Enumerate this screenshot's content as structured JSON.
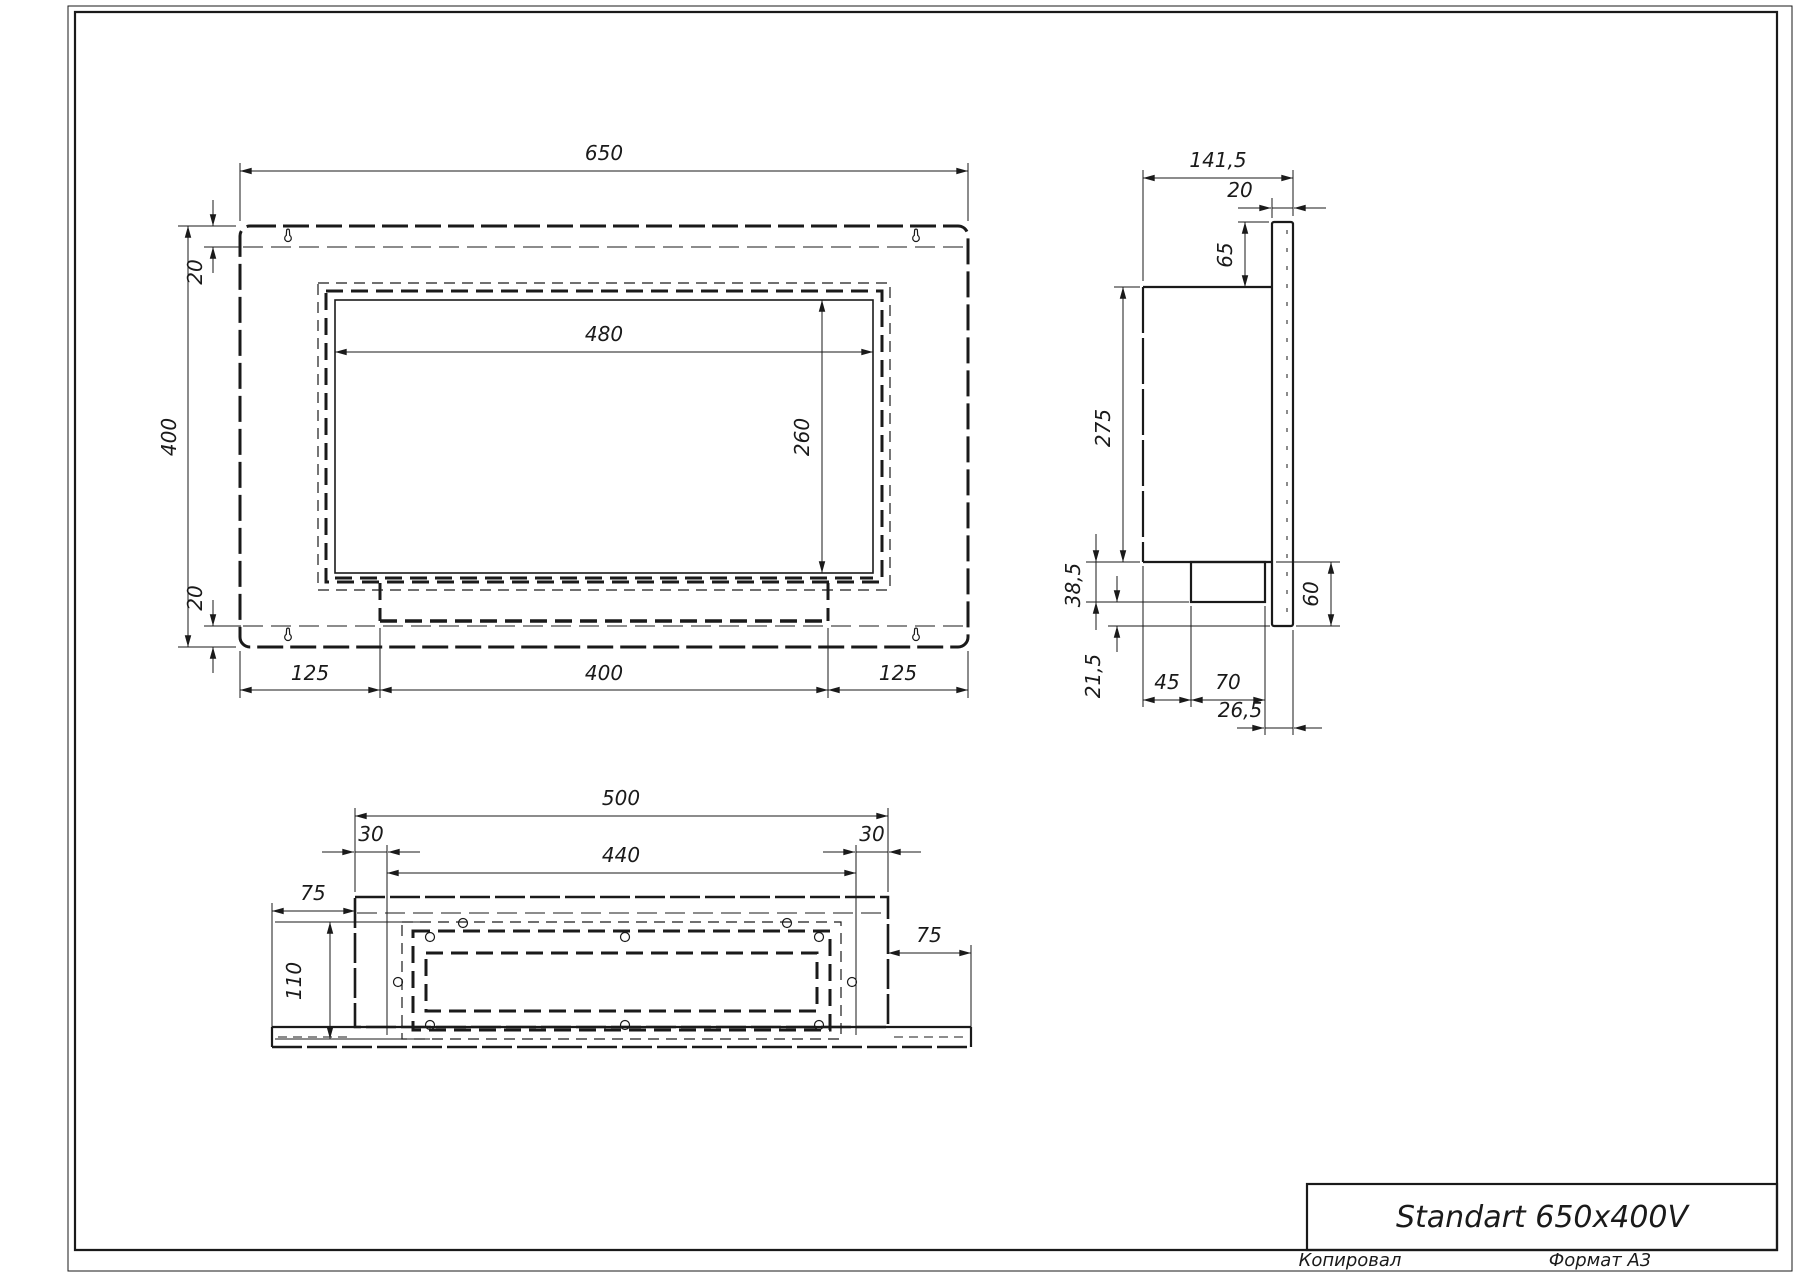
{
  "drawing": {
    "line_color": "#1a1a1a",
    "background_color": "#ffffff"
  },
  "front_view": {
    "width": "650",
    "height": "400",
    "offset_top": "20",
    "offset_bottom": "20",
    "opening_width": "480",
    "opening_height": "260",
    "margin_left": "125",
    "slot_width": "400",
    "margin_right": "125"
  },
  "side_view": {
    "depth": "141,5",
    "frame_thickness": "20",
    "flange_above": "65",
    "body_height": "275",
    "burner_height": "38,5",
    "flange_below_burner": "21,5",
    "burner_offset": "45",
    "burner_depth": "70",
    "corner_offset": "26,5",
    "flange_drop": "60"
  },
  "bottom_view": {
    "body_width": "500",
    "inset_left": "30",
    "opening_width": "440",
    "inset_right": "30",
    "wing_left": "75",
    "opening_depth": "110",
    "wing_right": "75"
  },
  "title_block": {
    "model_name": "Standart 650x400V",
    "copied_label": "Копировал",
    "format_label": "Формат А3"
  }
}
